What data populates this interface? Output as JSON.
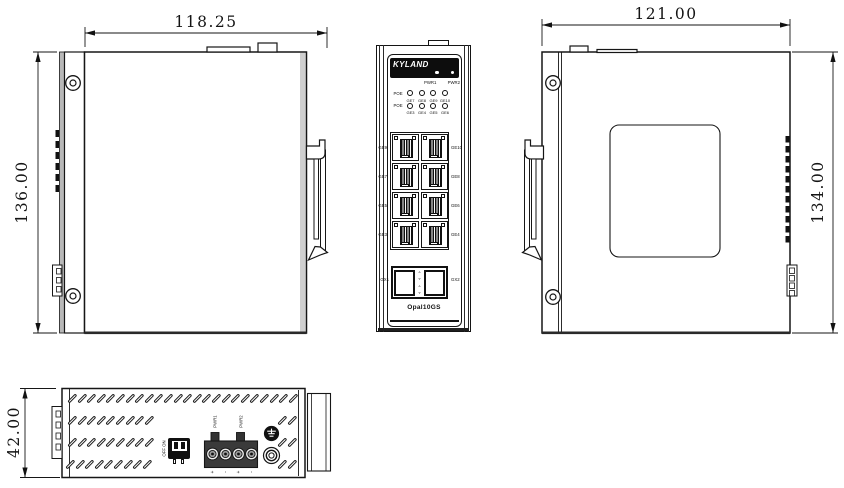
{
  "dimensions": {
    "left_view_width": "118.25",
    "left_view_height": "136.00",
    "right_view_width": "121.00",
    "right_view_height": "134.00",
    "bottom_view_height": "42.00"
  },
  "front": {
    "brand": "KYLAND",
    "model": "Opal10GS",
    "power_led_labels": [
      "PWR1",
      "PWR2"
    ],
    "led_rows": [
      {
        "label": "POE",
        "ports": [
          "GE7",
          "GE8",
          "GE9",
          "GE10"
        ]
      },
      {
        "label": "POE",
        "ports": [
          "GE3",
          "GE4",
          "GE5",
          "GE6"
        ]
      }
    ],
    "port_rows": [
      {
        "left": "GE9",
        "right": "GE10"
      },
      {
        "left": "GE7",
        "right": "GE8"
      },
      {
        "left": "GE5",
        "right": "GE6"
      },
      {
        "left": "GE3",
        "right": "GE4"
      }
    ],
    "sfp_labels": {
      "left": "GX1",
      "right": "GX2"
    },
    "sfp_arrows": [
      "▵",
      "▿",
      "▵",
      "▿"
    ]
  },
  "bottom": {
    "dip_labels": {
      "top": "OFF",
      "bottom": "ON"
    },
    "power_terminal_labels": [
      "PWR1",
      "PWR2"
    ],
    "terminal_polarity": [
      "+",
      "-",
      "+",
      "-"
    ]
  }
}
